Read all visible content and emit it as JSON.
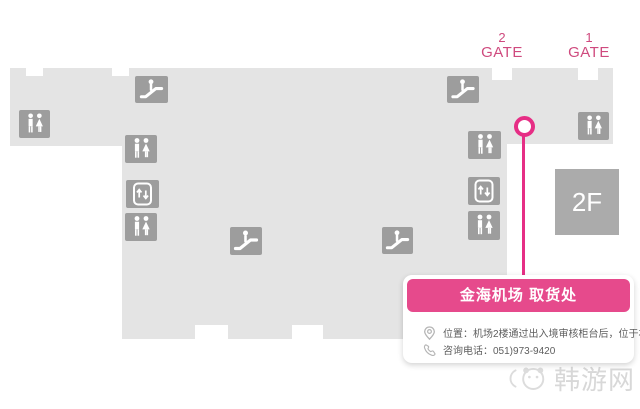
{
  "gates": [
    {
      "number": "2",
      "label": "GATE"
    },
    {
      "number": "1",
      "label": "GATE"
    }
  ],
  "floor_badge": "2F",
  "callout": {
    "title": "金海机场 取货处",
    "location_line": "位置：机场2楼通过出入境审核柜台后，位于右侧",
    "phone_line": "咨询电话：051)973-9420"
  },
  "watermark": {
    "text": "韩游网"
  },
  "map_icons": [
    {
      "type": "escalator",
      "x": 135,
      "y": 76,
      "w": 33,
      "h": 27
    },
    {
      "type": "restroom",
      "x": 19,
      "y": 110,
      "w": 31,
      "h": 28
    },
    {
      "type": "restroom",
      "x": 125,
      "y": 135,
      "w": 32,
      "h": 28
    },
    {
      "type": "elevator",
      "x": 126,
      "y": 180,
      "w": 33,
      "h": 28
    },
    {
      "type": "restroom",
      "x": 125,
      "y": 213,
      "w": 32,
      "h": 28
    },
    {
      "type": "escalator",
      "x": 230,
      "y": 227,
      "w": 32,
      "h": 28
    },
    {
      "type": "escalator",
      "x": 382,
      "y": 227,
      "w": 31,
      "h": 27
    },
    {
      "type": "escalator",
      "x": 447,
      "y": 76,
      "w": 32,
      "h": 27
    },
    {
      "type": "restroom",
      "x": 468,
      "y": 131,
      "w": 33,
      "h": 28
    },
    {
      "type": "elevator",
      "x": 468,
      "y": 177,
      "w": 32,
      "h": 28
    },
    {
      "type": "restroom",
      "x": 468,
      "y": 211,
      "w": 32,
      "h": 29
    },
    {
      "type": "restroom",
      "x": 578,
      "y": 112,
      "w": 31,
      "h": 28
    }
  ],
  "colors": {
    "map_fill": "#e4e4e4",
    "icon_fill": "#9d9d9d",
    "badge_fill": "#ababab",
    "accent": "#e64a8c",
    "marker": "#e62e85",
    "gate_text": "#cf4a7e",
    "info_text": "#5e5e5e",
    "watermark_text": "#d8d8d8"
  }
}
